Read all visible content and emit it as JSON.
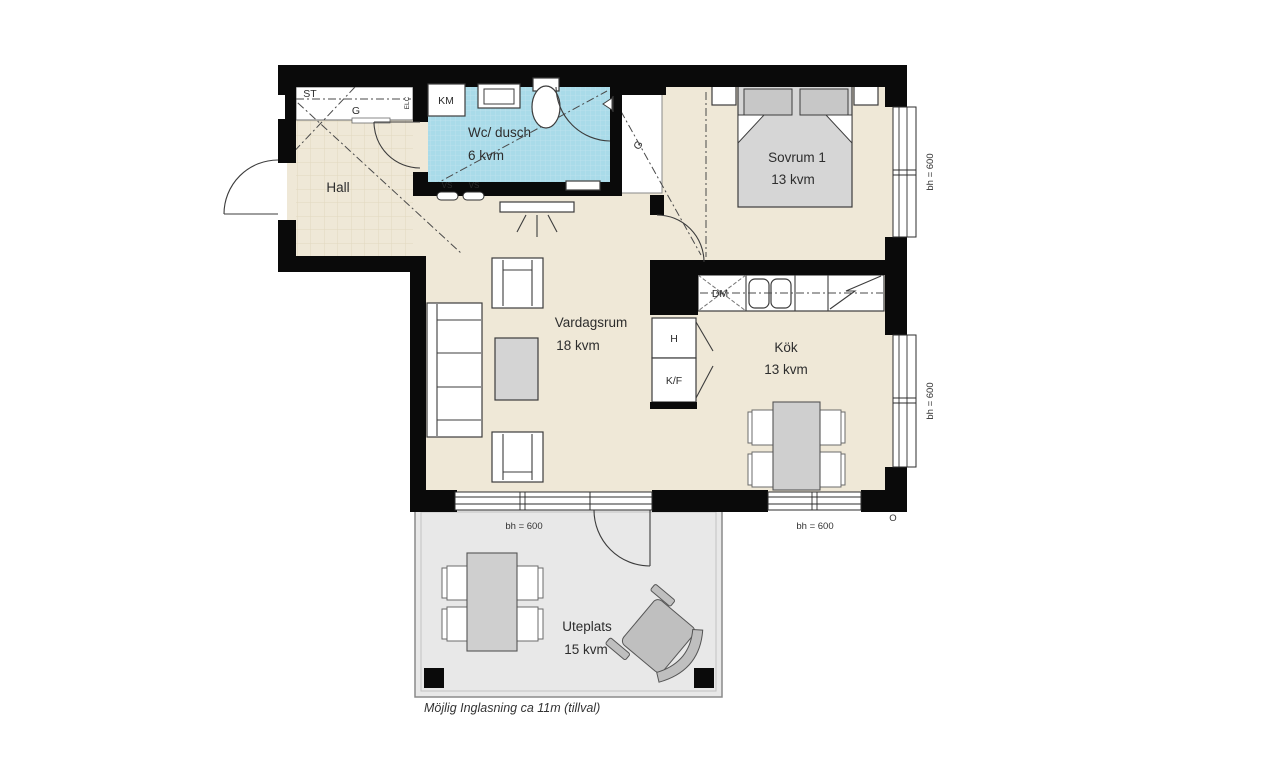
{
  "colors": {
    "wall": "#0a0a0a",
    "floor_beige": "#efe8d7",
    "bathroom_blue": "#a9dbe9",
    "patio_gray": "#e8e8e8",
    "furniture_gray": "#d4d4d4",
    "outline": "#3c3c3c"
  },
  "rooms": {
    "hall": {
      "label": "Hall"
    },
    "bathroom": {
      "label": "Wc/ dusch",
      "area": "6 kvm"
    },
    "bedroom": {
      "label": "Sovrum 1",
      "area": "13 kvm"
    },
    "living": {
      "label": "Vardagsrum",
      "area": "18 kvm"
    },
    "kitchen": {
      "label": "Kök",
      "area": "13 kvm"
    },
    "patio": {
      "label": "Uteplats",
      "area": "15 kvm"
    }
  },
  "fixtures": {
    "closet": "ST",
    "hall_wardrobe": "G",
    "electrical": "ELC",
    "washing_machine": "KM",
    "water_riser_1": "VS",
    "water_riser_2": "VS",
    "bedroom_wardrobe": "G",
    "dishwasher": "DM",
    "tall_cabinet": "H",
    "fridge_freezer": "K/F"
  },
  "windows": {
    "bedroom_right": "bh = 600",
    "kitchen_right": "bh = 600",
    "living_bottom": "bh = 600",
    "kitchen_bottom": "bh = 600"
  },
  "annotations": {
    "footnote": "Möjlig Inglasning ca 11m (tillval)",
    "corner_mark": "O"
  }
}
